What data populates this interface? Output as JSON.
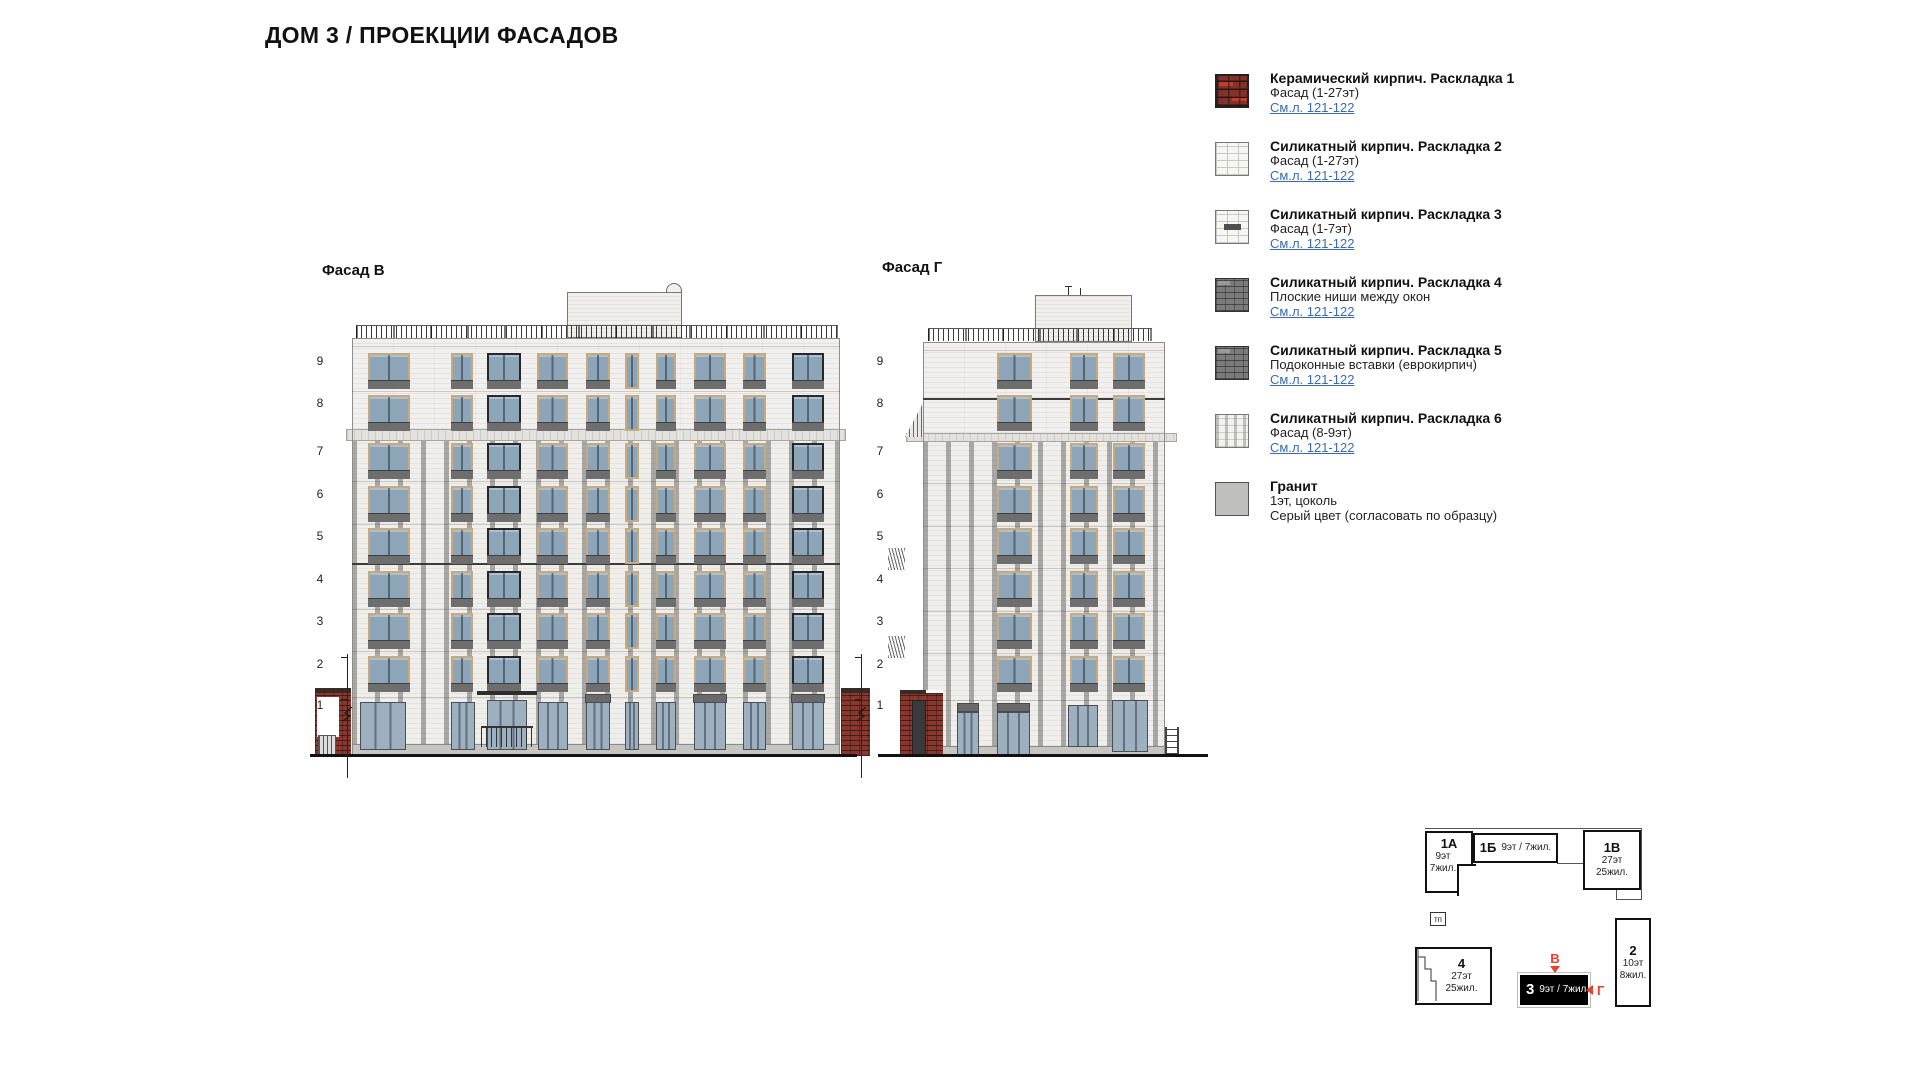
{
  "page": {
    "title": "ДОМ 3 / ПРОЕКЦИИ ФАСАДОВ"
  },
  "legend": {
    "items": [
      {
        "swatch": "sw-red",
        "icon": "ceramic-brick-swatch",
        "title": "Керамический кирпич. Раскладка 1",
        "line": "Фасад (1-27эт)",
        "link": "См.л. 121-122"
      },
      {
        "swatch": "sw-white",
        "icon": "silicate-brick-swatch",
        "title": "Силикатный кирпич. Раскладка 2",
        "line": "Фасад (1-27эт)",
        "link": "См.л. 121-122"
      },
      {
        "swatch": "sw-inset",
        "icon": "silicate-inset-swatch",
        "title": "Силикатный кирпич. Раскладка 3",
        "line": "Фасад (1-7эт)",
        "link": "См.л. 121-122"
      },
      {
        "swatch": "sw-dark",
        "icon": "dark-brick-swatch",
        "title": "Силикатный кирпич. Раскладка 4",
        "line": "Плоские ниши между окон",
        "link": "См.л. 121-122"
      },
      {
        "swatch": "sw-dark",
        "icon": "dark-brick-swatch",
        "title": "Силикатный кирпич. Раскладка 5",
        "line": "Подоконные вставки (еврокирпич)",
        "link": "См.л. 121-122"
      },
      {
        "swatch": "sw-white6",
        "icon": "silicate-brick-swatch",
        "title": "Силикатный кирпич. Раскладка 6",
        "line": "Фасад (8-9эт)",
        "link": "См.л. 121-122"
      },
      {
        "swatch": "sw-granite",
        "icon": "granite-swatch",
        "title": "Гранит",
        "line": "1эт, цоколь",
        "note": "Серый цвет (согласовать по образцу)"
      }
    ]
  },
  "facades": {
    "left": {
      "label": "Фасад В",
      "floors": [
        "9",
        "8",
        "7",
        "6",
        "5",
        "4",
        "3",
        "2",
        "1"
      ]
    },
    "right": {
      "label": "Фасад Г",
      "floors": [
        "9",
        "8",
        "7",
        "6",
        "5",
        "4",
        "3",
        "2",
        "1"
      ]
    }
  },
  "siteplan": {
    "b1a": {
      "id": "1А",
      "l1": "9эт",
      "l2": "7жил."
    },
    "b1b": {
      "id": "1Б",
      "sub": "9эт / 7жил."
    },
    "b1v": {
      "id": "1В",
      "l1": "27эт",
      "l2": "25жил."
    },
    "tp": {
      "id": "тп"
    },
    "b4": {
      "id": "4",
      "l1": "27эт",
      "l2": "25жил."
    },
    "b3": {
      "id": "3",
      "sub": "9эт / 7жил"
    },
    "b2": {
      "id": "2",
      "l1": "10эт",
      "l2": "8жил."
    },
    "marker_v": "В",
    "marker_g": "Г"
  },
  "colors": {
    "accent_red": "#e8402c",
    "link_blue": "#3b6ab0",
    "brick_red": "#8a382e",
    "glass_blue": "#8da5b8",
    "spandrel_gray": "#6e6e6e",
    "granite_gray": "#c6c5c2"
  }
}
